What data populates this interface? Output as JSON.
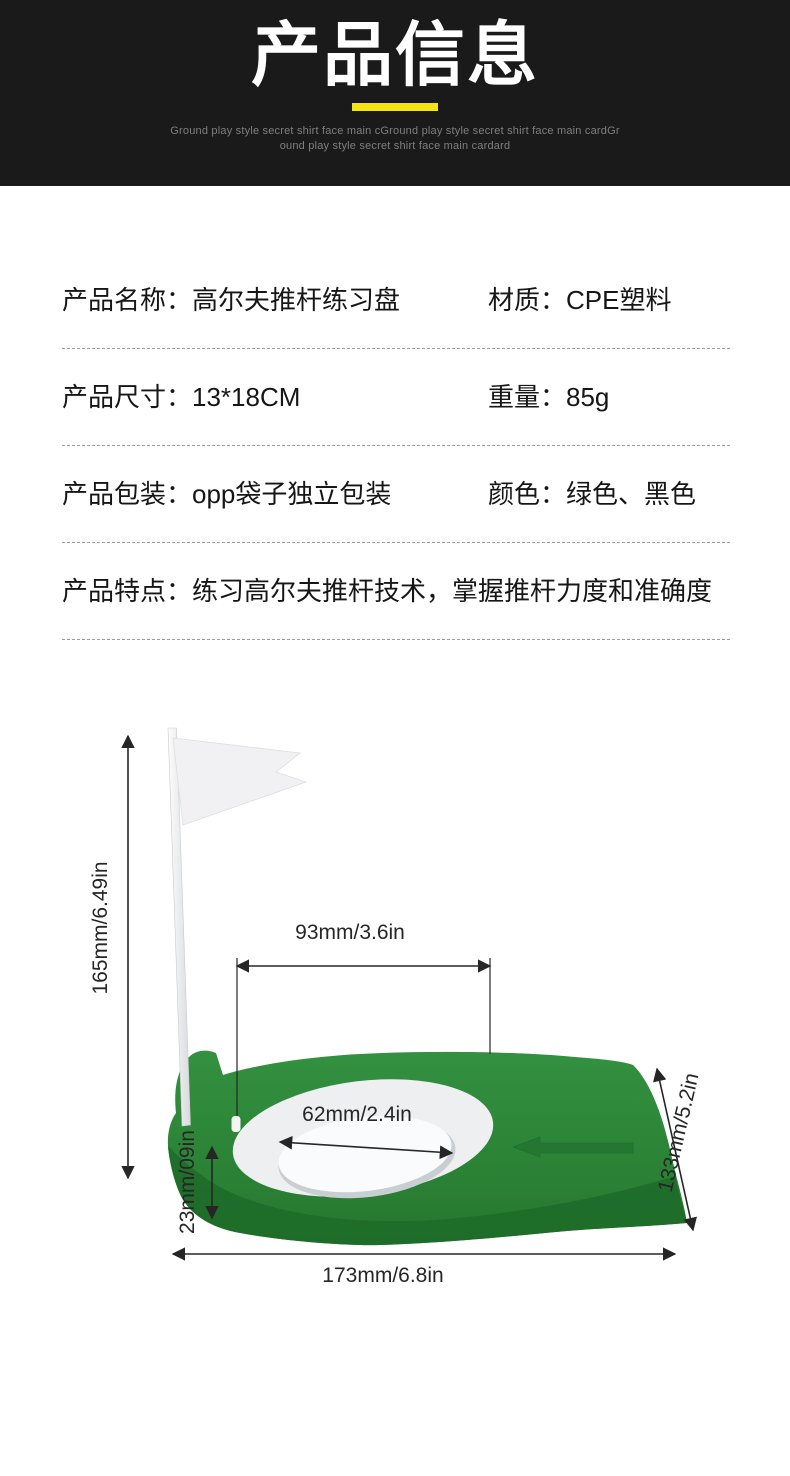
{
  "header": {
    "title": "产品信息",
    "subtitle_line1": "Ground play style secret shirt face main cGround play style secret shirt face main cardGr",
    "subtitle_line2": "ound play style secret shirt face main cardard",
    "accent_color": "#f3e50d",
    "background_color": "#1a1a1a"
  },
  "specs": {
    "rows": [
      {
        "label": "产品名称：",
        "value": "高尔夫推杆练习盘",
        "label2": "材质：",
        "value2": "CPE塑料"
      },
      {
        "label": "产品尺寸：",
        "value": "13*18CM",
        "label2": "重量：",
        "value2": "85g"
      },
      {
        "label": "产品包装：",
        "value": "opp袋子独立包装",
        "label2": "颜色：",
        "value2": "绿色、黑色"
      },
      {
        "label": "产品特点：",
        "value": "练习高尔夫推杆技术，掌握推杆力度和准确度"
      }
    ]
  },
  "figure": {
    "dims": {
      "height": "165mm/6.49in",
      "top_width": "93mm/3.6in",
      "hole_diameter": "62mm/2.4in",
      "thickness": "23mm/09in",
      "side_depth": "133mm/5.2in",
      "base_width": "173mm/6.8in"
    },
    "colors": {
      "disc_green": "#2a8034",
      "disc_green_dark": "#1e6b29",
      "ring_white": "#edeff1",
      "flag_white": "#f1f1f3",
      "dimension_line": "#262626"
    }
  }
}
